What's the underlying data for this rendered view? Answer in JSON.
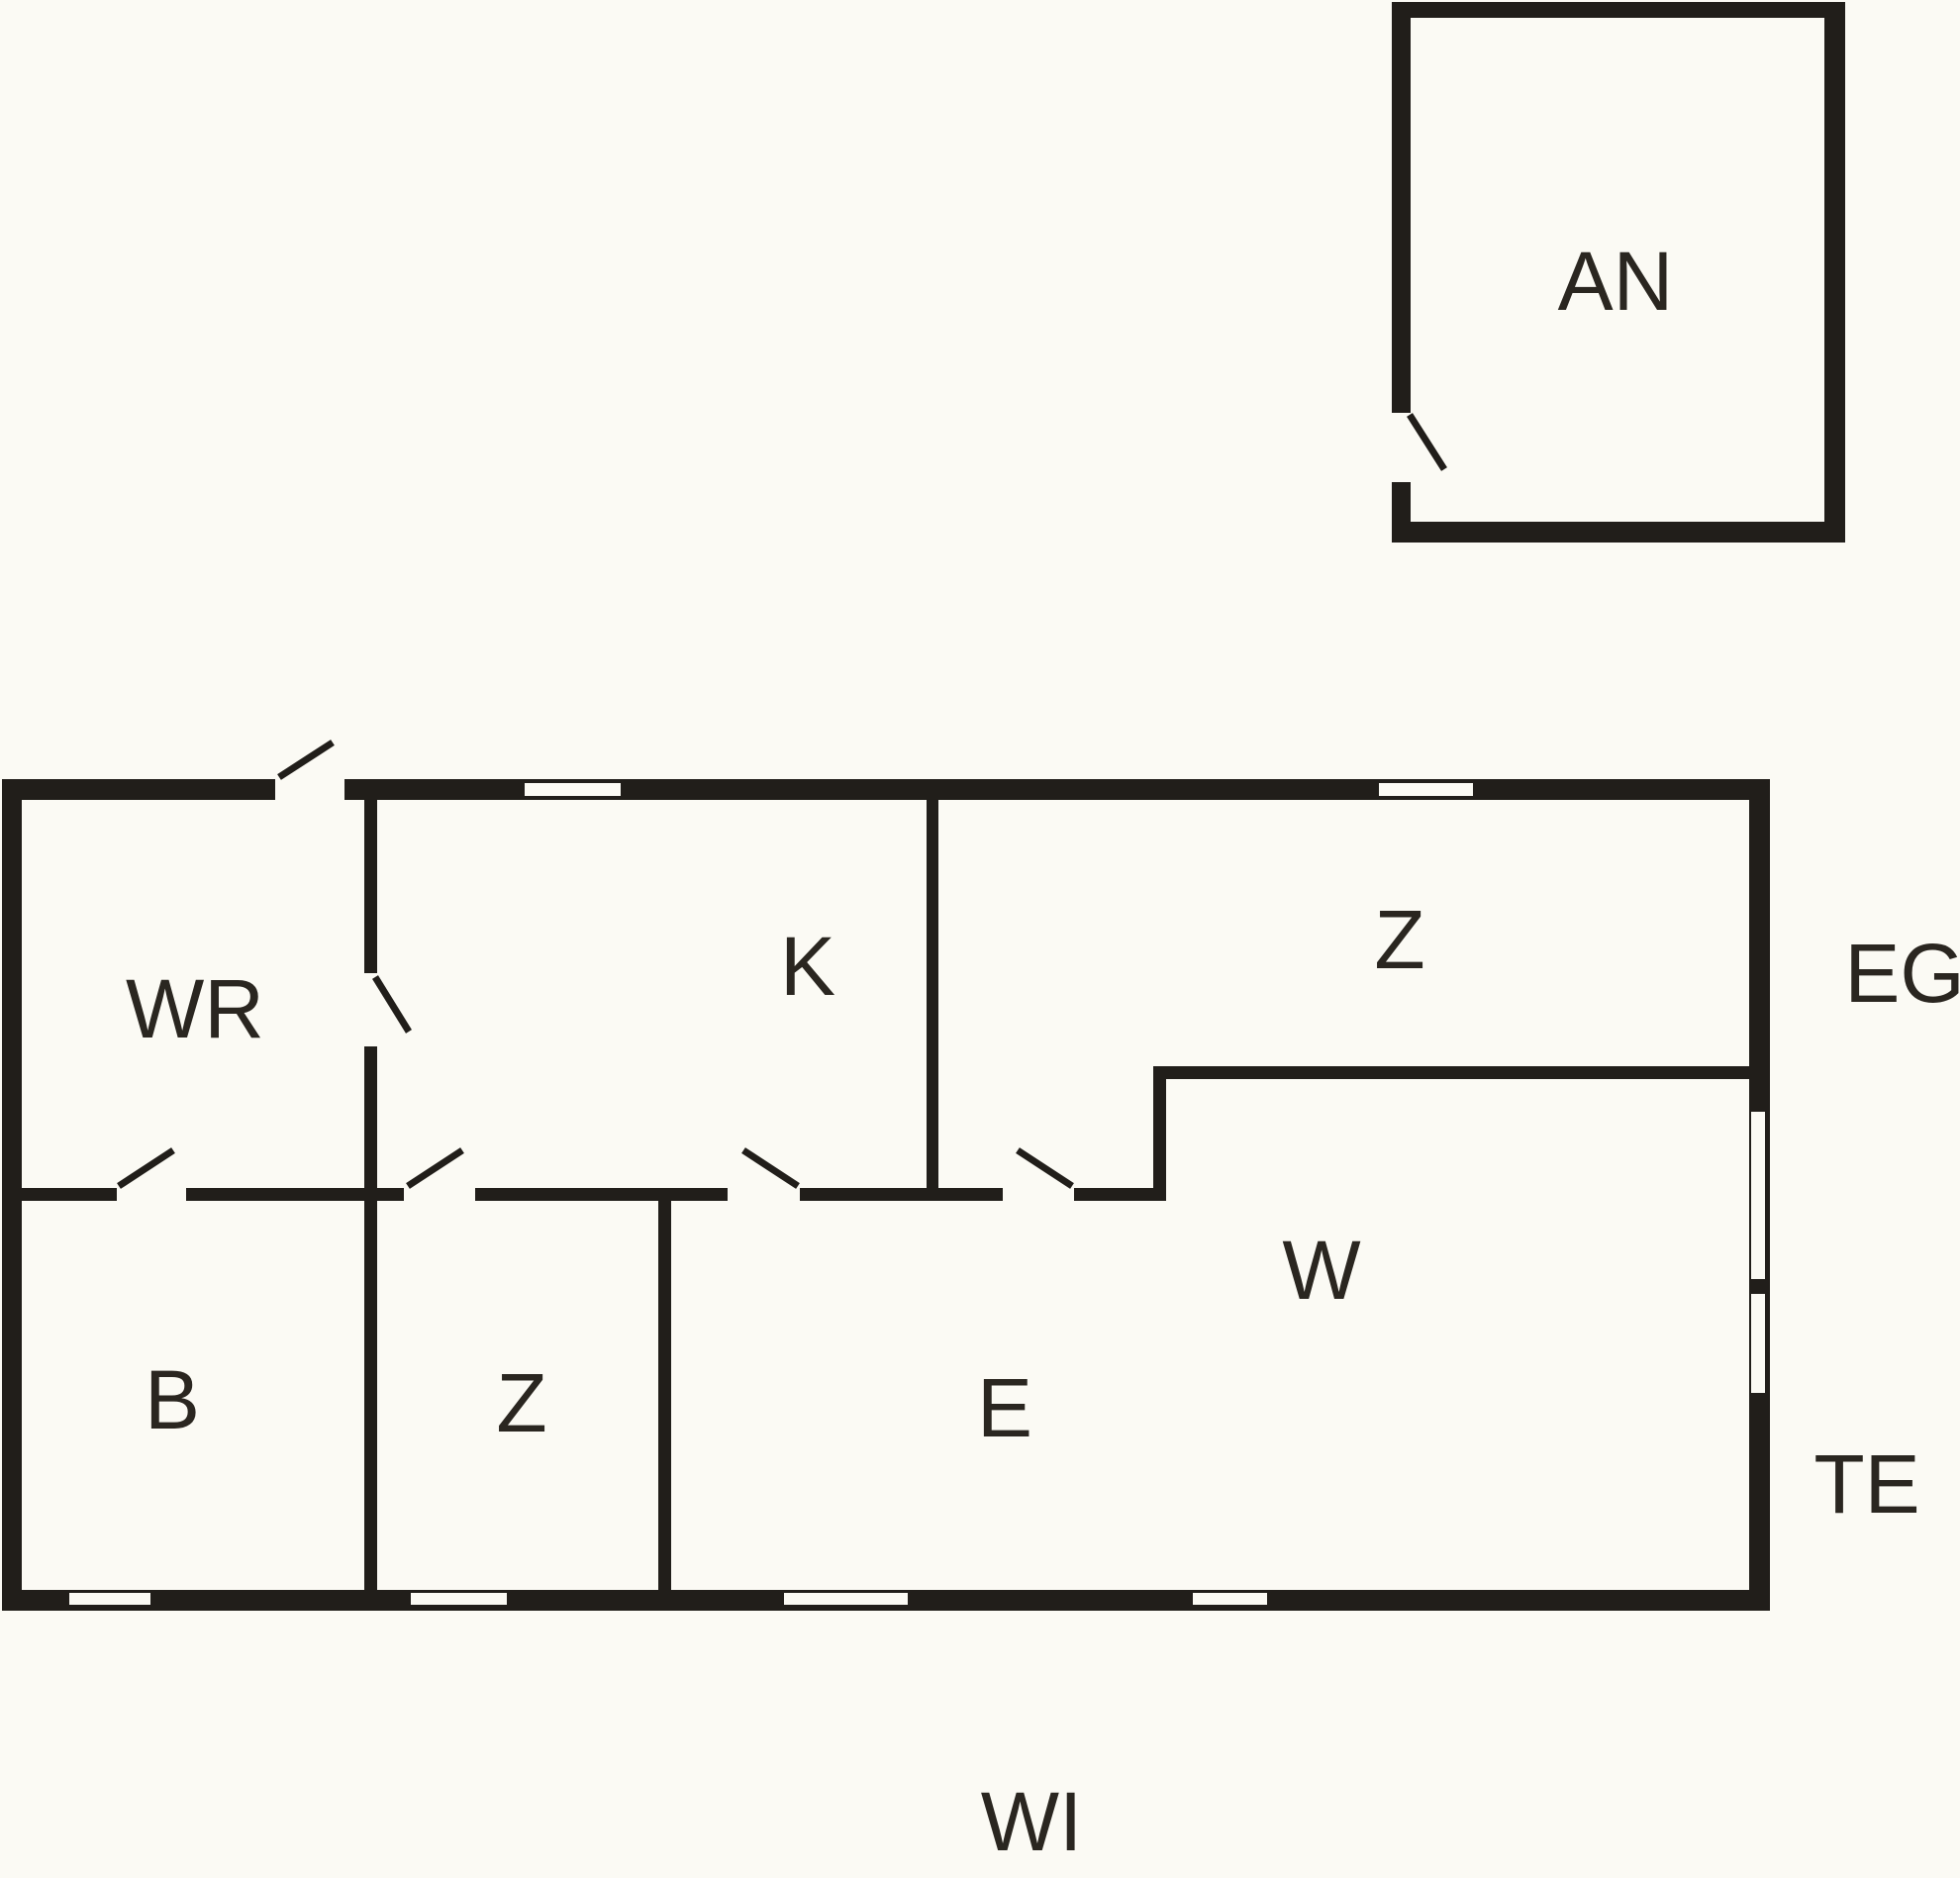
{
  "title": "Floor plan",
  "colors": {
    "wall": "#211e1a",
    "background": "#fbfaf4",
    "label": "#2a2620"
  },
  "rooms": [
    {
      "id": "an",
      "label": "AN"
    },
    {
      "id": "wr",
      "label": "WR"
    },
    {
      "id": "k",
      "label": "K"
    },
    {
      "id": "z-top",
      "label": "Z"
    },
    {
      "id": "b",
      "label": "B"
    },
    {
      "id": "z-bottom",
      "label": "Z"
    },
    {
      "id": "e",
      "label": "E"
    },
    {
      "id": "w",
      "label": "W"
    }
  ],
  "annotations": [
    {
      "id": "floor",
      "label": "EG"
    },
    {
      "id": "terrace",
      "label": "TE"
    },
    {
      "id": "garden",
      "label": "WI"
    }
  ]
}
